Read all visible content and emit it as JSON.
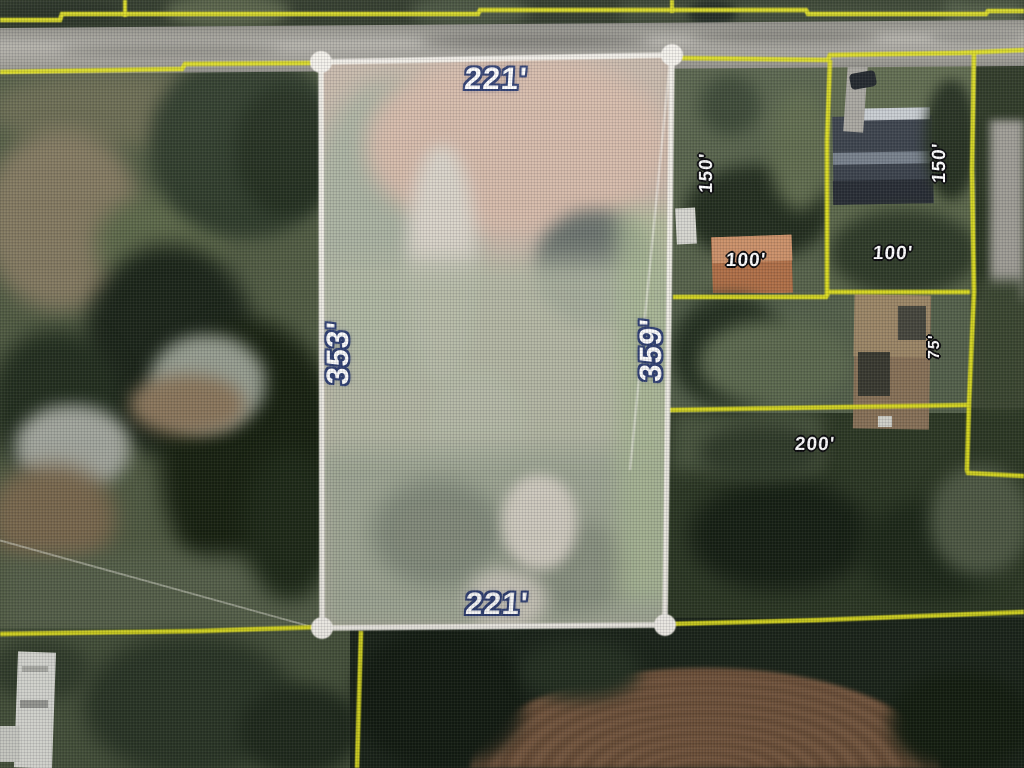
{
  "map": {
    "view": "aerial parcel survey overlay",
    "main_parcel": {
      "dimensions": {
        "top": "221'",
        "left": "353'",
        "right": "359'",
        "bottom": "221'"
      }
    },
    "adjacent_lots": [
      {
        "id": "northeast-lot-1",
        "depth": "150'",
        "frontage": "100'"
      },
      {
        "id": "northeast-lot-2",
        "depth": "150'",
        "frontage": "100'"
      },
      {
        "id": "east-lot-3",
        "width": "200'",
        "depth": "75'"
      }
    ],
    "colors": {
      "boundary_yellow": "#dcdc1e",
      "parcel_white": "#f4f1ea",
      "label_fill": "#ffffff",
      "label_outline_large": "#2f3f72",
      "label_outline_small": "#08080a"
    }
  }
}
